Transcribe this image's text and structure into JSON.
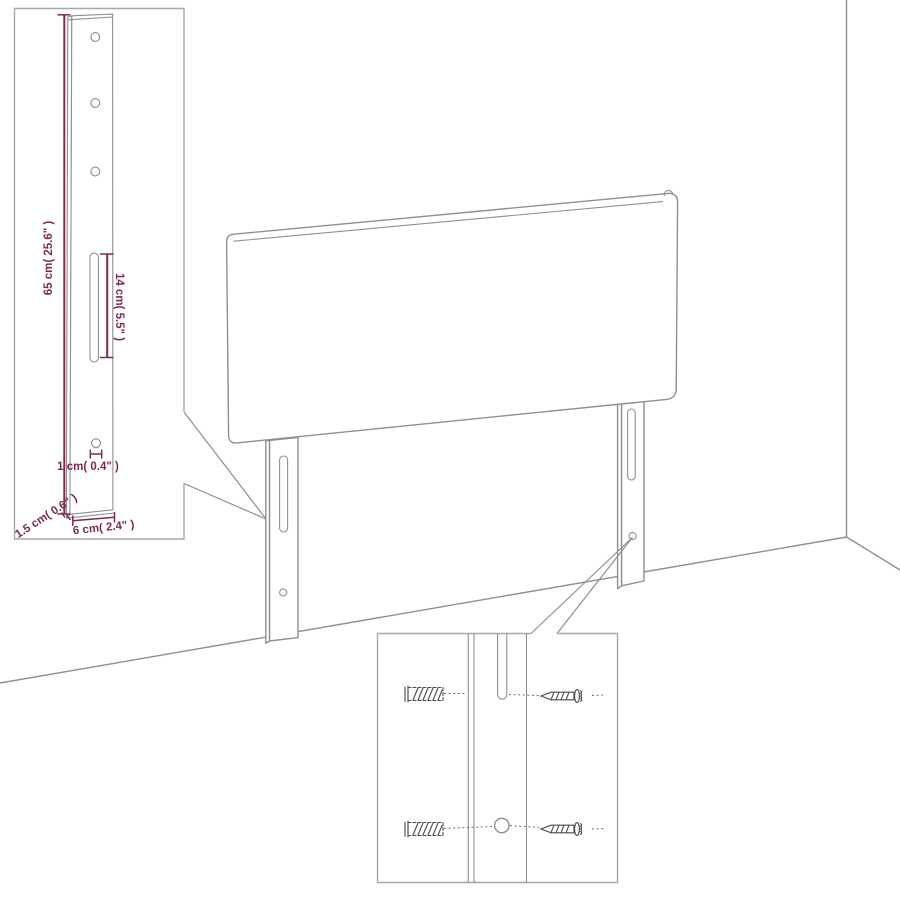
{
  "page": {
    "kind": "furniture assembly / dimension diagram",
    "subject": "upholstered headboard with two slotted mounting legs standing in a room corner, with two magnified detail callouts"
  },
  "colors": {
    "outline": "#8f8f8f",
    "panel_border": "#a8a8a8",
    "dimension": "#7b2a52",
    "hardware": "#4a4a4a",
    "leader": "#6e6e6e"
  },
  "leg_detail_panel": {
    "dimensions": {
      "height": "65 cm( 25.6\" )",
      "slot_length": "14 cm( 5.5\" )",
      "hole_diameter": "1 cm( 0.4\" )",
      "thickness": "1.5 cm( 0.6\" )",
      "width": "6 cm( 2.4\" )"
    }
  },
  "hardware_detail_panel": {
    "icons": {
      "wall_plug": "wall-plug-icon",
      "screw": "screw-icon"
    },
    "rows": 2
  }
}
